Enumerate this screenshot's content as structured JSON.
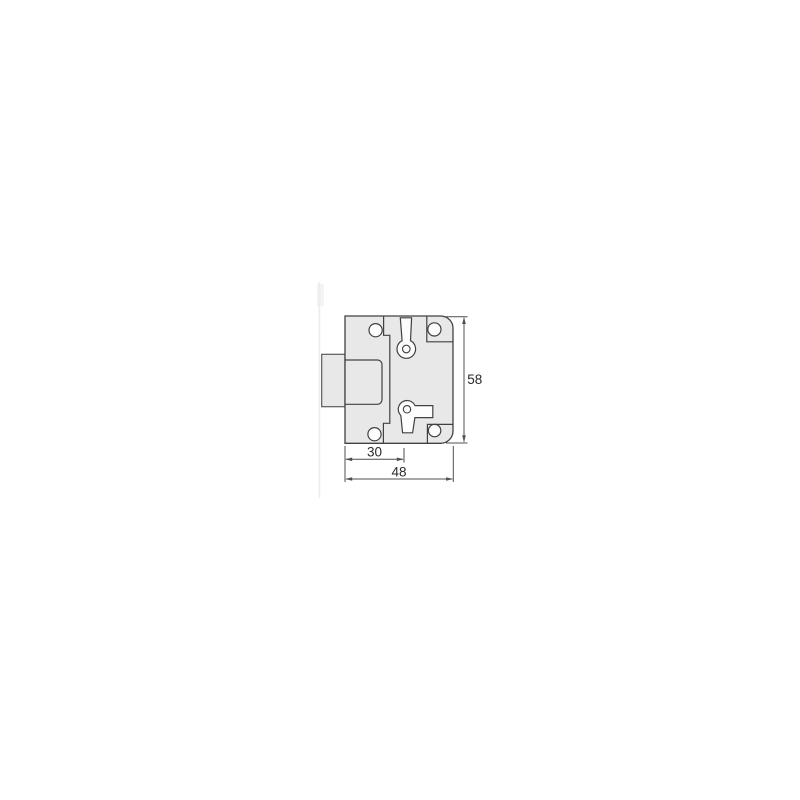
{
  "drawing": {
    "type": "technical-drawing",
    "subject": "cabinet-lock-front-view",
    "colors": {
      "background": "#ffffff",
      "body_fill": "#e8e8e8",
      "outline": "#414141",
      "hole_fill": "#fdfdfd",
      "dimension_line": "#4f4f4f",
      "label_text": "#2a2a2a"
    },
    "dimensions": {
      "backset": {
        "value": "30"
      },
      "total_width": {
        "value": "48"
      },
      "total_height": {
        "value": "58"
      }
    }
  }
}
